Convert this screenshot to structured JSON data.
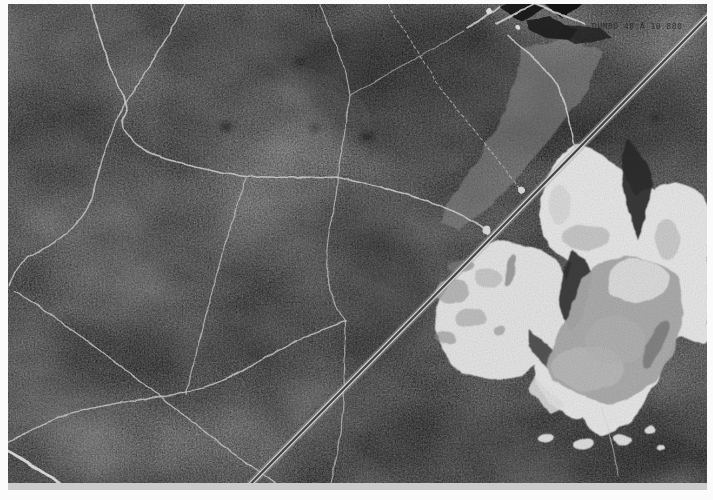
{
  "photo": {
    "stamp_text": "DUMBO  48  A 10 880"
  },
  "colors": {
    "paper_white": "#fbfbfb",
    "forest_dark": "#3f3f3f",
    "quarry_white": "#f2f2f2",
    "pond_gray": "#b2b2b2",
    "track_white": "#dedede",
    "road_white": "#efefef",
    "field_black": "#141414",
    "corridor_gray": "#9b9b9b"
  }
}
